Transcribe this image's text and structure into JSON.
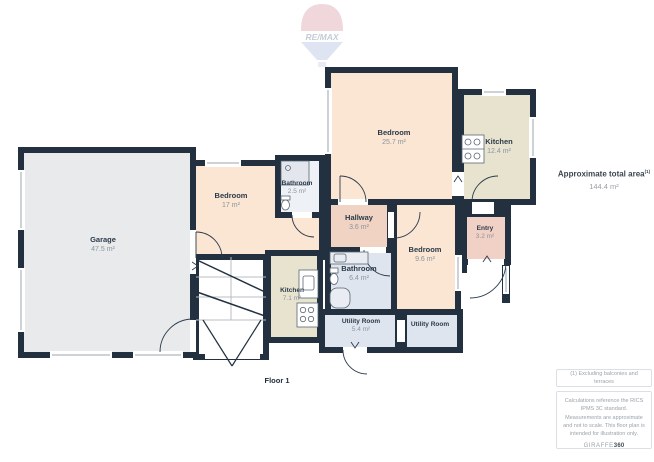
{
  "branding": {
    "remax_label": "RE/MAX",
    "giraffe_label": "GIRAFFE",
    "giraffe_360": "360"
  },
  "floor": {
    "label": "Floor 1"
  },
  "summary": {
    "title": "Approximate total area",
    "superscript": "(1)",
    "value": "144.4 m²"
  },
  "notes": {
    "footnote": "(1) Excluding balconies and terraces",
    "disclaimer": "Calculations reference the RICS IPMS 3C standard. Measurements are approximate and not to scale. This floor plan is intended for illustration only."
  },
  "rooms": [
    {
      "name": "Garage",
      "area": "47.5 m²"
    },
    {
      "name": "Bedroom",
      "area": "17 m²"
    },
    {
      "name": "Bathroom",
      "area": "2.5 m²"
    },
    {
      "name": "Bedroom",
      "area": "25.7 m²"
    },
    {
      "name": "Kitchen",
      "area": "12.4 m²"
    },
    {
      "name": "Hallway",
      "area": "3.6 m²"
    },
    {
      "name": "Bathroom",
      "area": "6.4 m²"
    },
    {
      "name": "Bedroom",
      "area": "9.6 m²"
    },
    {
      "name": "Entry",
      "area": "3.2 m²"
    },
    {
      "name": "Kitchen",
      "area": "7.1 m²"
    },
    {
      "name": "Utility Room",
      "area": "5.4 m²"
    },
    {
      "name": "Utility Room",
      "area": ""
    }
  ],
  "colors": {
    "wall": "#22303f",
    "bedroom_fill": "#fbe5d3",
    "kitchen_fill": "#e8e3cf",
    "garage_fill": "#e8eaec",
    "bathroom_fill": "#dfe5ee",
    "hallway_fill": "#f0d3c2",
    "small_bath_fill": "#eef1f5",
    "remax_red": "#cf7d8a",
    "remax_blue": "#93a9d2"
  }
}
